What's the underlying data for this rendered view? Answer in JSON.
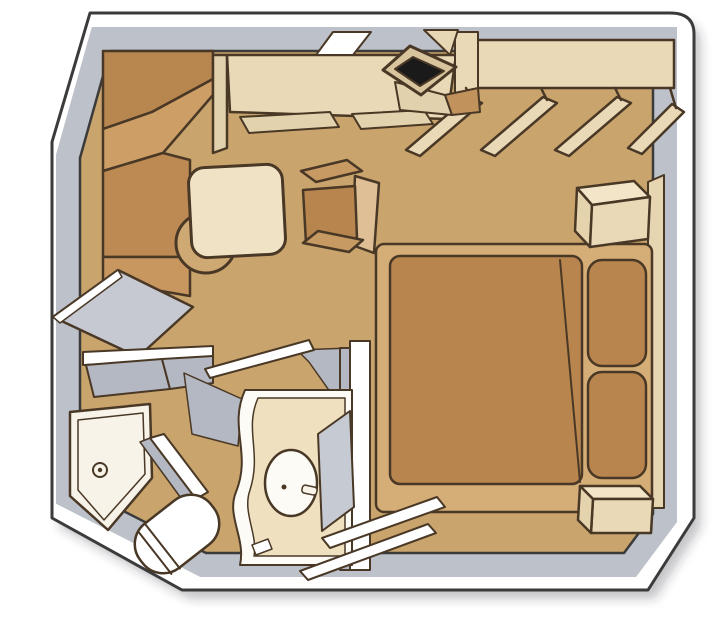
{
  "diagram": {
    "kind": "floorplan",
    "subject": "cabin-stateroom-isometric-floorplan",
    "width": 726,
    "height": 619,
    "background": "#ffffff",
    "palette": {
      "floor": "#c9a46d",
      "wall_face_gray": "#bdc1c9",
      "wall_white": "#ffffff",
      "furniture_outline": "#4a3826",
      "wall_outline": "#3b3b3b",
      "wood_dark": "#b8864f",
      "wood_mid": "#cd9e66",
      "cream": "#ead9b6",
      "bedspread": "#b8854e",
      "tv_screen": "#1a1a1a",
      "bath_gray": "#b4b8c2",
      "porcelain": "#fdfbf5"
    },
    "legend": [
      "corner-wardrobe",
      "desk-vanity",
      "wall-mirror",
      "tv",
      "closet-shelf",
      "clothes-hangers",
      "round-table",
      "tub-armchair",
      "double-bed",
      "pillows",
      "nightstand-upper",
      "nightstand-lower",
      "partition-panel",
      "bathroom",
      "shower",
      "toilet",
      "sink-vanity",
      "bathroom-mirror",
      "bathroom-door",
      "entry-door"
    ],
    "shapes": [
      {
        "name": "plan-shadow",
        "tag": "path",
        "attrs": {
          "d": "M 97,22 L 677,22 Q 701,22 701,43 L 701,527 L 655,599 L 189,599 L 59,527 L 59,151 Z",
          "fill": "rgba(50,50,60,0.28)",
          "stroke": "none",
          "filter": "url(#soft)"
        }
      },
      {
        "name": "outer-wall",
        "tag": "path",
        "attrs": {
          "d": "M 90,13 L 670,13 Q 694,13 694,34 L 694,518 L 648,590 L 182,590 L 52,518 L 52,142 Z",
          "fill": "#ffffff",
          "stroke": "#3b3b3b",
          "stroke-width": 3
        }
      },
      {
        "name": "wall-inner-face",
        "tag": "path",
        "attrs": {
          "d": "M 110,51 L 653,51 L 653,514 L 624,553 L 206,553 L 80,489 L 80,158 Z",
          "fill": "none",
          "stroke": "#bdc1c9",
          "stroke-width": 48,
          "stroke-linejoin": "miter"
        }
      },
      {
        "name": "floor",
        "tag": "path",
        "attrs": {
          "d": "M 110,51 L 653,51 L 653,514 L 624,553 L 206,553 L 80,489 L 80,158 Z",
          "fill": "#c9a46d",
          "stroke": "#3b3b3b",
          "stroke-width": 2.5
        }
      },
      {
        "name": "wardrobe-facet-1",
        "tag": "polygon",
        "attrs": {
          "points": "103,51 213,51 213,79 152,112 103,129",
          "fill": "#b8864f"
        }
      },
      {
        "name": "wardrobe-facet-2",
        "tag": "polygon",
        "attrs": {
          "points": "103,129 152,112 213,79 213,95 163,153 103,171",
          "fill": "#cd9e66"
        }
      },
      {
        "name": "wardrobe-facet-3",
        "tag": "polygon",
        "attrs": {
          "points": "103,171 163,153 190,160 190,257 103,257",
          "fill": "#bc8a52"
        }
      },
      {
        "name": "wardrobe-facet-4",
        "tag": "polygon",
        "attrs": {
          "points": "103,257 190,257 190,296 103,281",
          "fill": "#c89760"
        }
      },
      {
        "name": "desk-side-panel",
        "tag": "polygon",
        "attrs": {
          "points": "213,55 227,55 227,148 213,153",
          "fill": "#e2d1ad"
        }
      },
      {
        "name": "desk",
        "tag": "polygon",
        "attrs": {
          "points": "227,55 456,55 447,119 230,112",
          "fill": "#ead9b6"
        }
      },
      {
        "name": "desk-mirror",
        "tag": "polygon",
        "attrs": {
          "points": "333,32 371,32 353,55 316,55",
          "fill": "#ffffff",
          "stroke-width": 2
        }
      },
      {
        "name": "desk-drawer-1",
        "tag": "polygon",
        "attrs": {
          "points": "240,117 330,112 339,127 249,133",
          "fill": "#e3d2ae",
          "stroke-width": 2
        }
      },
      {
        "name": "desk-drawer-2",
        "tag": "polygon",
        "attrs": {
          "points": "352,114 424,110 433,124 361,129",
          "fill": "#e3d2ae",
          "stroke-width": 2
        }
      },
      {
        "name": "closet-shelf",
        "tag": "polygon",
        "attrs": {
          "points": "462,40 674,40 674,88 455,88",
          "fill": "#ead9b6"
        }
      },
      {
        "name": "desk-return",
        "tag": "polygon",
        "attrs": {
          "points": "455,32 478,32 478,108 455,112",
          "fill": "#ead9b6",
          "stroke-width": 2
        }
      },
      {
        "name": "hanger-1",
        "tag": "polygon",
        "attrs": {
          "points": "406,150 468,97 482,103 420,156",
          "fill": "#ead9b6"
        }
      },
      {
        "name": "hanger-2",
        "tag": "polygon",
        "attrs": {
          "points": "481,150 543,97 557,103 495,156",
          "fill": "#ead9b6"
        }
      },
      {
        "name": "hanger-3",
        "tag": "polygon",
        "attrs": {
          "points": "555,150 617,97 631,103 569,156",
          "fill": "#ead9b6"
        }
      },
      {
        "name": "hanger-4",
        "tag": "polygon",
        "attrs": {
          "points": "628,148 672,104 684,112 642,154",
          "fill": "#ead9b6"
        }
      },
      {
        "name": "hanger-hook-1",
        "tag": "line",
        "attrs": {
          "x1": 472,
          "y1": 100,
          "x2": 466,
          "y2": 88
        }
      },
      {
        "name": "hanger-hook-2",
        "tag": "line",
        "attrs": {
          "x1": 547,
          "y1": 100,
          "x2": 541,
          "y2": 88
        }
      },
      {
        "name": "hanger-hook-3",
        "tag": "line",
        "attrs": {
          "x1": 621,
          "y1": 100,
          "x2": 615,
          "y2": 88
        }
      },
      {
        "name": "hanger-hook-4",
        "tag": "line",
        "attrs": {
          "x1": 676,
          "y1": 108,
          "x2": 670,
          "y2": 88
        }
      },
      {
        "name": "tv-mount",
        "tag": "polygon",
        "attrs": {
          "points": "424,30 458,30 450,55",
          "fill": "#e8d7b5",
          "stroke-width": 2
        }
      },
      {
        "name": "tv-stand",
        "tag": "polygon",
        "attrs": {
          "points": "395,82 445,95 452,115 400,110",
          "fill": "#e2d1ad",
          "stroke-width": 2
        }
      },
      {
        "name": "tv-stand-side",
        "tag": "polygon",
        "attrs": {
          "points": "445,95 478,88 480,112 452,115",
          "fill": "#c1925c",
          "stroke-width": 2
        }
      },
      {
        "name": "tv-frame",
        "tag": "polygon",
        "attrs": {
          "points": "410,46 456,67 421,95 383,70",
          "fill": "#d8c59e",
          "stroke-width": 3
        }
      },
      {
        "name": "tv-screen",
        "tag": "polygon",
        "attrs": {
          "points": "413,57 444,71 420,86 395,69",
          "fill": "#1a1a1a",
          "stroke-width": 2
        }
      },
      {
        "name": "table-pedestal",
        "tag": "circle",
        "attrs": {
          "cx": 206,
          "cy": 243,
          "r": 30,
          "fill": "#cfa973",
          "stroke-width": 3
        }
      },
      {
        "name": "table-top",
        "tag": "rect",
        "attrs": {
          "x": 190,
          "y": 166,
          "width": 94,
          "height": 90,
          "rx": 16,
          "transform": "rotate(-3 237 211)",
          "fill": "#f0e3c5",
          "stroke-width": 3
        }
      },
      {
        "name": "chair-back",
        "tag": "polygon",
        "attrs": {
          "points": "355,176 379,183 374,253 352,245",
          "fill": "#dfc096"
        }
      },
      {
        "name": "chair-seat",
        "tag": "polygon",
        "attrs": {
          "points": "303,190 355,186 357,238 306,243",
          "fill": "#b8854e"
        }
      },
      {
        "name": "chair-arm-top",
        "tag": "polygon",
        "attrs": {
          "points": "301,171 347,160 362,171 316,182",
          "fill": "#c79a63"
        }
      },
      {
        "name": "chair-arm-bottom",
        "tag": "polygon",
        "attrs": {
          "points": "303,243 318,231 363,240 349,252",
          "fill": "#c79a63"
        }
      },
      {
        "name": "bed-headboard",
        "tag": "polygon",
        "attrs": {
          "points": "648,182 664,175 664,508 648,508",
          "fill": "#e7d5b2",
          "stroke-width": 2
        }
      },
      {
        "name": "bed-base",
        "tag": "rect",
        "attrs": {
          "x": 376,
          "y": 244,
          "width": 276,
          "height": 268,
          "rx": 8,
          "fill": "#d4ad77"
        }
      },
      {
        "name": "bed-blanket",
        "tag": "rect",
        "attrs": {
          "x": 390,
          "y": 256,
          "width": 192,
          "height": 228,
          "rx": 10,
          "fill": "#b8854e"
        }
      },
      {
        "name": "bed-crease",
        "tag": "path",
        "attrs": {
          "d": "M 560,260 L 580,482",
          "fill": "none",
          "stroke-width": 2
        }
      },
      {
        "name": "pillow-1",
        "tag": "rect",
        "attrs": {
          "x": 588,
          "y": 260,
          "width": 58,
          "height": 106,
          "rx": 14,
          "fill": "#b8854e"
        }
      },
      {
        "name": "pillow-2",
        "tag": "rect",
        "attrs": {
          "x": 588,
          "y": 372,
          "width": 58,
          "height": 106,
          "rx": 14,
          "fill": "#b8854e"
        }
      },
      {
        "name": "nightstand-upper-top",
        "tag": "polygon",
        "attrs": {
          "points": "577,188 634,181 650,197 592,205",
          "fill": "#f2e5c8"
        }
      },
      {
        "name": "nightstand-upper-side",
        "tag": "polygon",
        "attrs": {
          "points": "577,188 592,205 590,247 575,231",
          "fill": "#e5d3ae"
        }
      },
      {
        "name": "nightstand-upper-front",
        "tag": "polygon",
        "attrs": {
          "points": "592,205 650,197 648,239 590,247",
          "fill": "#ead9b6"
        }
      },
      {
        "name": "nightstand-lower-top",
        "tag": "polygon",
        "attrs": {
          "points": "580,486 640,486 653,499 593,499",
          "fill": "#f2e5c8"
        }
      },
      {
        "name": "nightstand-lower-front",
        "tag": "polygon",
        "attrs": {
          "points": "593,499 653,499 651,533 591,533",
          "fill": "#ead9b6"
        }
      },
      {
        "name": "nightstand-lower-side",
        "tag": "polygon",
        "attrs": {
          "points": "580,486 593,499 591,533 578,520",
          "fill": "#e5d3ae"
        }
      },
      {
        "name": "partition-panel",
        "tag": "polygon",
        "attrs": {
          "points": "118,270 193,307 138,357 53,317",
          "fill": "#c6c9d2"
        }
      },
      {
        "name": "partition-edge",
        "tag": "polygon",
        "attrs": {
          "points": "118,270 53,317 60,323 122,277",
          "fill": "#ffffff",
          "stroke-width": 1.5
        }
      },
      {
        "name": "bath-wall-top",
        "tag": "polygon",
        "attrs": {
          "points": "83,352 213,346 213,359 83,365",
          "fill": "#ffffff",
          "stroke-width": 2
        }
      },
      {
        "name": "bath-wall-top-face",
        "tag": "polygon",
        "attrs": {
          "points": "86,365 162,359 170,389 94,397",
          "fill": "#b4b8c2",
          "stroke-width": 2
        }
      },
      {
        "name": "bath-wall-top-face-2",
        "tag": "polygon",
        "attrs": {
          "points": "162,359 213,356 213,383 170,389",
          "fill": "#b4b8c2",
          "stroke-width": 2
        }
      },
      {
        "name": "bath-floor-shade-left",
        "tag": "polygon",
        "attrs": {
          "points": "184,373 242,399 238,446 192,434",
          "fill": "#b4b8c2",
          "stroke-width": 1.5
        }
      },
      {
        "name": "bath-floor-shade-right",
        "tag": "polygon",
        "attrs": {
          "points": "297,350 350,348 350,420 309,362",
          "fill": "#b4b8c2",
          "stroke-width": 1.5
        }
      },
      {
        "name": "bath-wall-right-face",
        "tag": "polygon",
        "attrs": {
          "points": "340,348 350,348 350,570 340,570",
          "fill": "#b4b8c2",
          "stroke-width": 2
        }
      },
      {
        "name": "bath-wall-right",
        "tag": "polygon",
        "attrs": {
          "points": "350,341 370,341 370,570 350,570",
          "fill": "#ffffff",
          "stroke-width": 2
        }
      },
      {
        "name": "bathroom-door",
        "tag": "polygon",
        "attrs": {
          "points": "205,369 309,340 314,350 210,378",
          "fill": "#ffffff",
          "stroke-width": 2
        }
      },
      {
        "name": "shower-tray",
        "tag": "polygon",
        "attrs": {
          "points": "70,412 150,404 152,478 108,530 70,496",
          "fill": "#f7f3e8",
          "stroke-width": 2.5
        }
      },
      {
        "name": "shower-tray-inner",
        "tag": "polygon",
        "attrs": {
          "points": "78,420 143,413 145,474 104,520 78,490",
          "fill": "none",
          "stroke-width": 1.5
        }
      },
      {
        "name": "shower-drain",
        "tag": "circle",
        "attrs": {
          "cx": 100,
          "cy": 470,
          "r": 7,
          "fill": "none",
          "stroke-width": 2
        }
      },
      {
        "name": "shower-drain-dot",
        "tag": "circle",
        "attrs": {
          "cx": 100,
          "cy": 470,
          "r": 2.2,
          "fill": "#4a3826",
          "stroke": "none"
        }
      },
      {
        "name": "shower-door-shade",
        "tag": "polygon",
        "attrs": {
          "points": "140,442 150,438 196,499 186,505",
          "fill": "#b4b8c2",
          "stroke-width": 1.5
        }
      },
      {
        "name": "shower-door",
        "tag": "polygon",
        "attrs": {
          "points": "150,438 164,434 208,492 196,499",
          "fill": "#ffffff",
          "stroke-width": 2
        }
      },
      {
        "name": "toilet-body",
        "tag": "rect",
        "attrs": {
          "x": 132,
          "y": 506,
          "width": 90,
          "height": 56,
          "rx": 26,
          "transform": "rotate(-38 177 534)",
          "fill": "#ffffff",
          "stroke-width": 2.5
        }
      },
      {
        "name": "toilet-seat-line-1",
        "tag": "line",
        "attrs": {
          "x1": 148,
          "y1": 508,
          "x2": 148,
          "y2": 562,
          "transform": "rotate(-38 177 534)",
          "stroke-width": 2
        }
      },
      {
        "name": "toilet-seat-line-2",
        "tag": "line",
        "attrs": {
          "x1": 158,
          "y1": 507,
          "x2": 158,
          "y2": 563,
          "transform": "rotate(-38 177 534)",
          "stroke-width": 2
        }
      },
      {
        "name": "vanity-counter",
        "tag": "path",
        "attrs": {
          "d": "M 245,390 C 228,428 252,452 236,492 C 226,516 246,538 240,565 L 352,565 L 352,390 Z",
          "fill": "#fdfbf5",
          "stroke-width": 2
        }
      },
      {
        "name": "vanity-counter-face",
        "tag": "path",
        "attrs": {
          "d": "M 258,398 C 244,430 262,452 250,490 C 242,512 258,534 254,556 L 345,556 L 345,398 Z",
          "fill": "#efe1bf",
          "stroke-width": 1.5
        }
      },
      {
        "name": "sink-basin",
        "tag": "ellipse",
        "attrs": {
          "cx": 291,
          "cy": 483,
          "rx": 26,
          "ry": 33,
          "fill": "#fdfbf5",
          "stroke-width": 2.5
        }
      },
      {
        "name": "sink-faucet-handle",
        "tag": "rect",
        "attrs": {
          "x": 302,
          "y": 486,
          "width": 15,
          "height": 8,
          "rx": 3,
          "transform": "rotate(12 309 490)",
          "fill": "#f7f3e8",
          "stroke-width": 1.5
        }
      },
      {
        "name": "sink-faucet-dot",
        "tag": "circle",
        "attrs": {
          "cx": 284,
          "cy": 487,
          "r": 2.5,
          "fill": "#4a3826",
          "stroke": "none"
        }
      },
      {
        "name": "bathroom-mirror",
        "tag": "polygon",
        "attrs": {
          "points": "318,434 350,411 354,507 322,531",
          "fill": "#c6cad3",
          "stroke-width": 2
        }
      },
      {
        "name": "entry-door-jamb",
        "tag": "polygon",
        "attrs": {
          "points": "252,545 268,539 272,549 256,555",
          "fill": "#ffffff",
          "stroke-width": 1.5
        }
      },
      {
        "name": "entry-door-leaf-1",
        "tag": "polygon",
        "attrs": {
          "points": "322,538 437,497 445,507 330,548",
          "fill": "#ffffff",
          "stroke-width": 2
        }
      },
      {
        "name": "entry-door-leaf-2",
        "tag": "polygon",
        "attrs": {
          "points": "300,571 428,524 436,533 308,580",
          "fill": "#ffffff",
          "stroke-width": 2
        }
      }
    ]
  }
}
